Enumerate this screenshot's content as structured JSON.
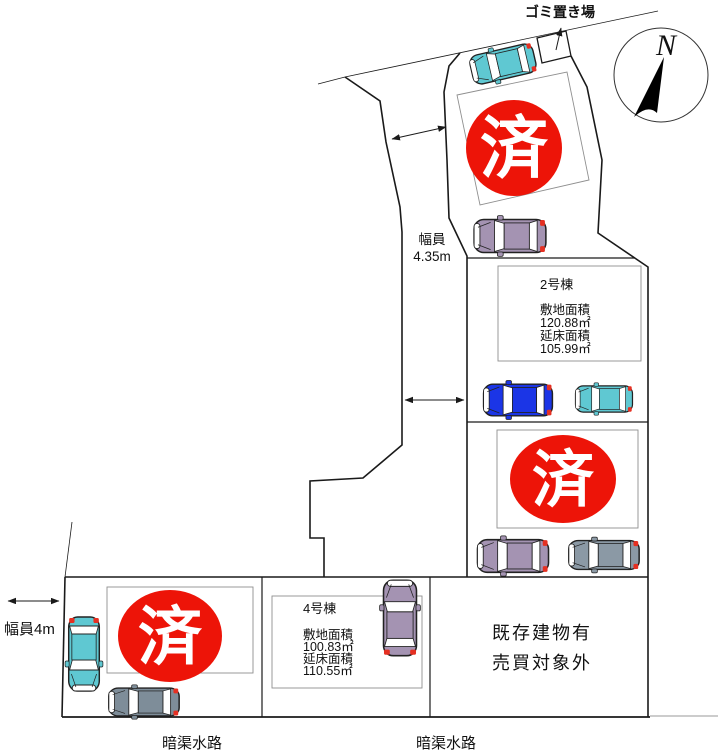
{
  "compass": {
    "label": "N"
  },
  "garbage_area": {
    "label": "ゴミ置き場"
  },
  "road_top": {
    "width_label_line1": "幅員",
    "width_label_line2": "4.35m"
  },
  "road_left": {
    "width_label": "幅員4m"
  },
  "waterway": {
    "label_left": "暗渠水路",
    "label_right": "暗渠水路"
  },
  "sold_mark": {
    "label": "済",
    "color": "#ed1408",
    "text_color": "#ffffff"
  },
  "lot_2": {
    "name": "2号棟",
    "site_area_label": "敷地面積",
    "site_area_value": "120.88㎡",
    "floor_area_label": "延床面積",
    "floor_area_value": "105.99㎡"
  },
  "lot_4": {
    "name": "4号棟",
    "site_area_label": "敷地面積",
    "site_area_value": "100.83㎡",
    "floor_area_label": "延床面積",
    "floor_area_value": "110.55㎡"
  },
  "existing_building": {
    "line1": "既存建物有",
    "line2": "売買対象外"
  },
  "car_colors": {
    "teal": "#5fc8d2",
    "purple": "#a493b2",
    "blue": "#1b35e6",
    "gray": "#8b99a5",
    "dark_gray": "#7e8d99"
  }
}
